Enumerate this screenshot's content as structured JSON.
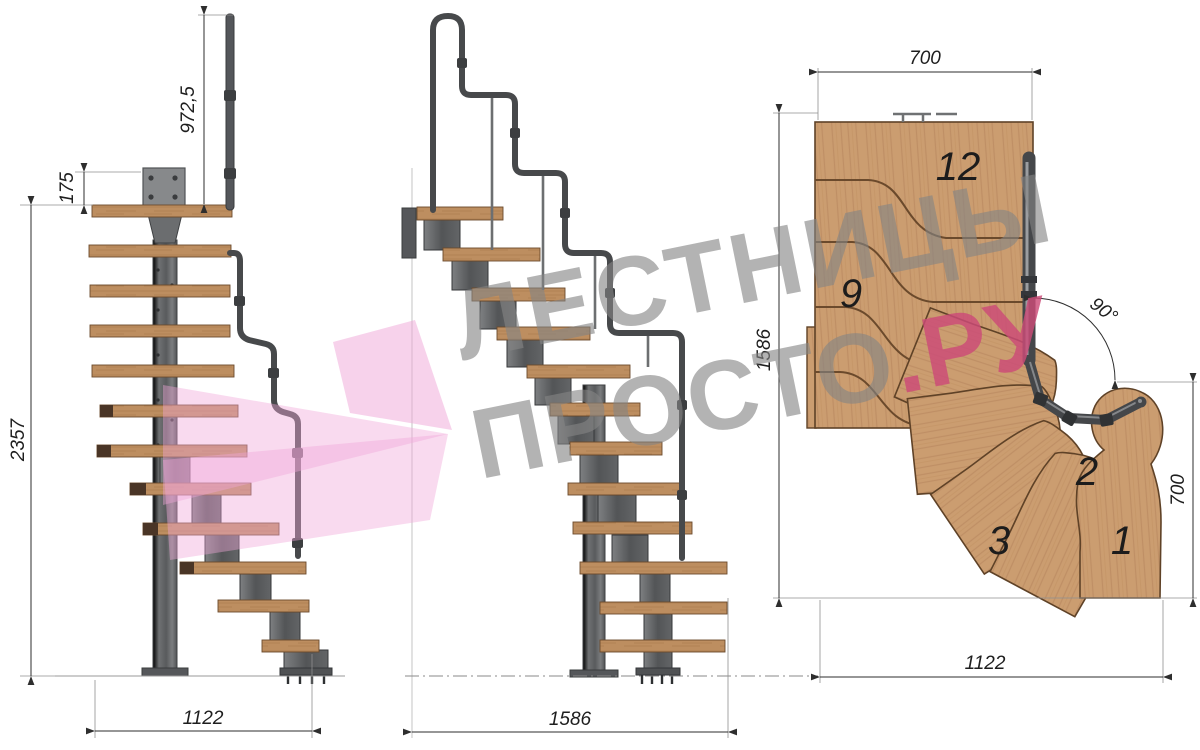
{
  "title": "Modular staircase technical drawing",
  "watermark": {
    "line1": "ЛЕСТНИЦЫ",
    "line2_gray": "ПРОСТО",
    "line2_accent": ".РУ"
  },
  "views": {
    "front": {
      "label": "front elevation",
      "dims": {
        "rail_height": "972,5",
        "mount_plate": "175",
        "total_height": "2357",
        "width": "1122"
      }
    },
    "side": {
      "label": "side elevation",
      "dims": {
        "length": "1586"
      }
    },
    "plan": {
      "label": "top plan",
      "dims": {
        "top_width": "700",
        "left_length": "1586",
        "right_depth": "700",
        "bottom_width": "1122",
        "turn_angle": "90°"
      },
      "step_labels": [
        "12",
        "9",
        "3",
        "2",
        "1"
      ]
    }
  },
  "colors": {
    "wood": "#c89a6c",
    "wood_outline": "#5f4227",
    "metal": "#6e7072",
    "rail": "#47494b",
    "dimension": "#2e2e2e",
    "watermark_gray": "#858585",
    "watermark_pink": "#cc4a78",
    "arrow_pink": "#f0a6d8"
  }
}
